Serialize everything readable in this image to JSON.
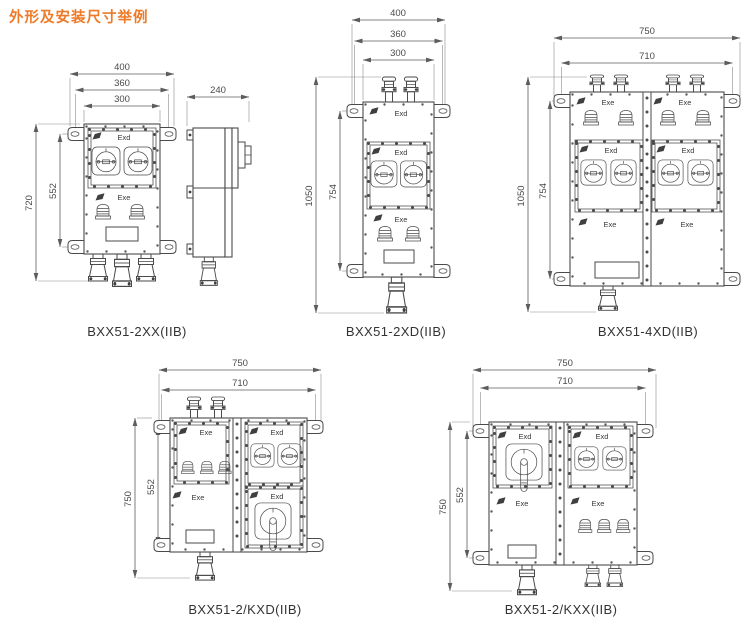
{
  "title": "外形及安装尺寸举例",
  "colors": {
    "accent": "#ee7a28",
    "line": "#4a4a4a"
  },
  "markings": {
    "exd": "Exd",
    "exe": "Exe"
  },
  "drawings": {
    "d1": {
      "label": "BXX51-2XX(IIB)",
      "top": [
        "400",
        "360",
        "300"
      ],
      "left": [
        "720",
        "552"
      ]
    },
    "side": {
      "top": [
        "240"
      ]
    },
    "d2": {
      "label": "BXX51-2XD(IIB)",
      "top": [
        "400",
        "360",
        "300"
      ],
      "left": [
        "1050",
        "754"
      ]
    },
    "d3": {
      "label": "BXX51-4XD(IIB)",
      "top": [
        "750",
        "710"
      ],
      "left": [
        "1050",
        "754"
      ]
    },
    "d4": {
      "label": "BXX51-2/KXD(IIB)",
      "top": [
        "750",
        "710"
      ],
      "left": [
        "750",
        "552"
      ]
    },
    "d5": {
      "label": "BXX51-2/KXX(IIB)",
      "top": [
        "750",
        "710"
      ],
      "left": [
        "750",
        "552"
      ]
    }
  }
}
